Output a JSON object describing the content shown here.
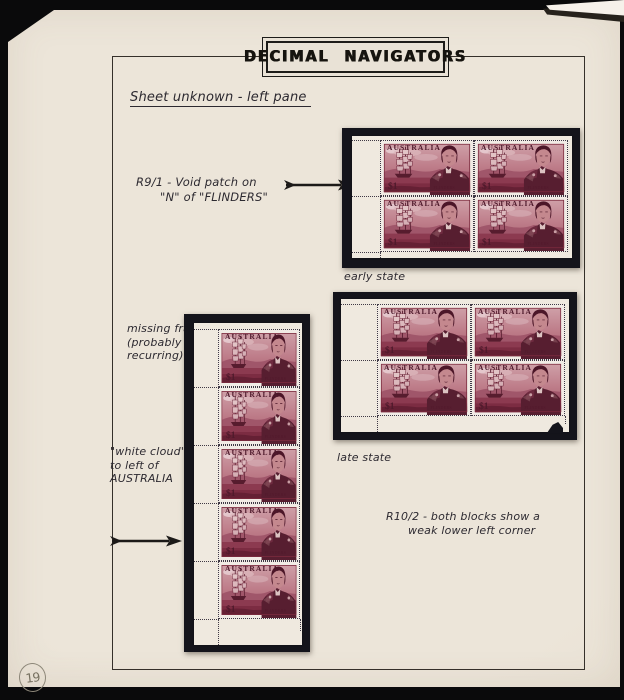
{
  "header": {
    "title": "DECIMAL NAVIGATORS"
  },
  "content": {
    "heading": "Sheet unknown - left pane",
    "r9_note": {
      "line1": "R9/1 -  Void patch on",
      "line2": "\"N\" of \"FLINDERS\""
    },
    "early_state_label": "early state",
    "late_state_label": "late state",
    "missing_frame_note": {
      "line1": "missing frame",
      "line2": "(probably non-",
      "line3": "recurring)"
    },
    "white_cloud_note": {
      "line1": "\"white cloud\"",
      "line2": "to left of",
      "line3": "AUSTRALIA"
    },
    "r10_note": {
      "line1": "R10/2  -  both blocks show a",
      "line2": "weak lower left corner"
    }
  },
  "stamp": {
    "country": "AUSTRALIA",
    "denomination": "$1",
    "caption": "FLINDERS"
  },
  "page": {
    "number": "19"
  },
  "colors": {
    "stamp_carmine": "#8c3a50",
    "mount_black": "#14141b",
    "page_paper": "#e9e2d6",
    "pane_paper": "#efe9df"
  }
}
